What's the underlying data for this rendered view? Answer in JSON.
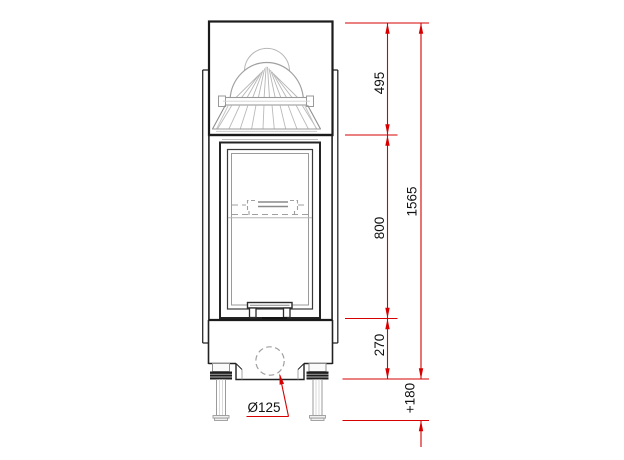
{
  "drawing": {
    "subject": "fireplace-insert-front-elevation",
    "dimensions": {
      "top_section": "495",
      "firebox_section": "800",
      "base_section": "270",
      "total_height": "1565",
      "leg_height": "+180",
      "flue_diameter": "Ø125"
    },
    "colors": {
      "dimension_red": "#d60000",
      "outline_black": "#1b1b1b",
      "detail_gray": "#a0a0a0"
    }
  }
}
